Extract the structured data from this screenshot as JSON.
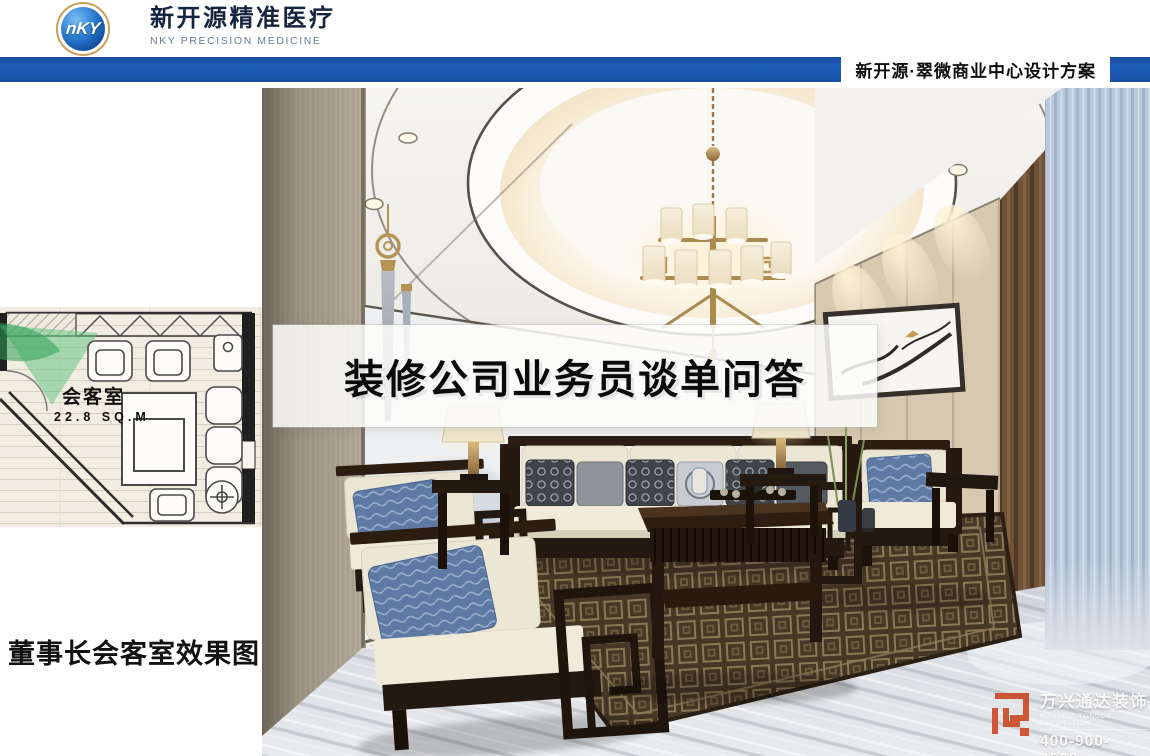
{
  "header": {
    "logo_text": "nKY",
    "brand_cn": "新开源精准医疗",
    "brand_en": "NKY PRECISION MEDICINE",
    "doc_title": "新开源·翠微商业中心设计方案"
  },
  "floorplan": {
    "room_label": "会客室",
    "area_label": "22.8 SQ.M"
  },
  "overlay_title": "装修公司业务员谈单问答",
  "caption": "董事长会客室效果图",
  "watermark": {
    "brand": "万兴通达装饰",
    "tagline": "WANXING TONGDA DECORATION",
    "phone": "400-900-4560"
  },
  "colors": {
    "accent_blue": "#1c5dba",
    "logo_gold": "#c9a05a",
    "plan_green": "#5cc37b",
    "watermark_orange": "#cc4a28"
  }
}
